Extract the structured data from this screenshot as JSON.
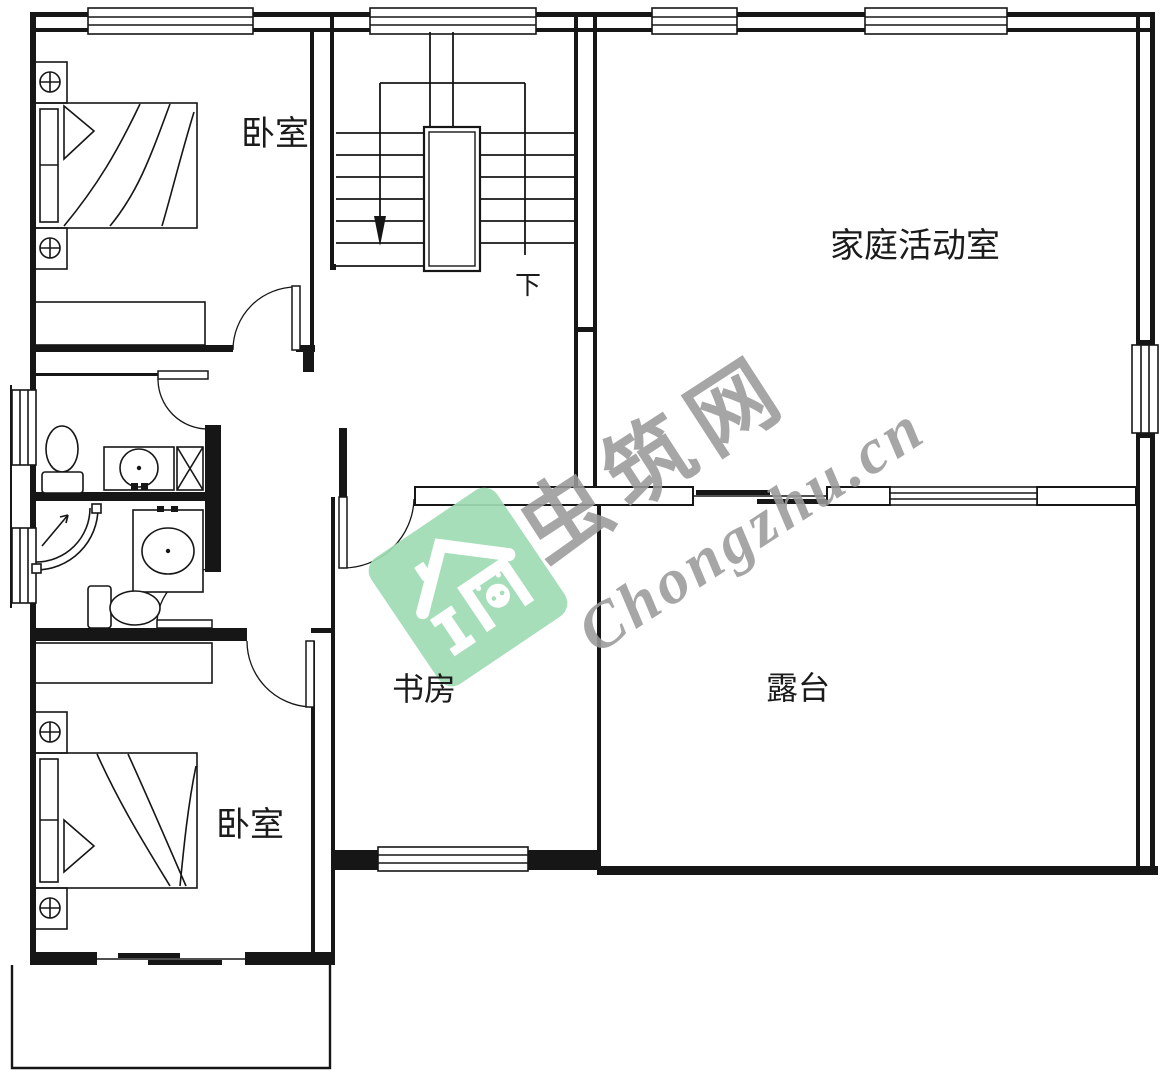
{
  "canvas": {
    "type": "residential floor plan (second storey)",
    "background": "#ffffff",
    "line_color": "#161616"
  },
  "rooms": {
    "bedroom_top": {
      "label": "卧室"
    },
    "family_activity": {
      "label": "家庭活动室"
    },
    "study": {
      "label": "书房"
    },
    "terrace": {
      "label": "露台"
    },
    "bedroom_bottom": {
      "label": "卧室"
    }
  },
  "stairs": {
    "down_label": "下"
  },
  "watermark": {
    "brand_cn": "虫筑网",
    "brand_en": "Chongzhu.cn",
    "logo_color": "#9edcb4",
    "text_color": "#9a9a9a",
    "logo_icon": "house-icon"
  }
}
